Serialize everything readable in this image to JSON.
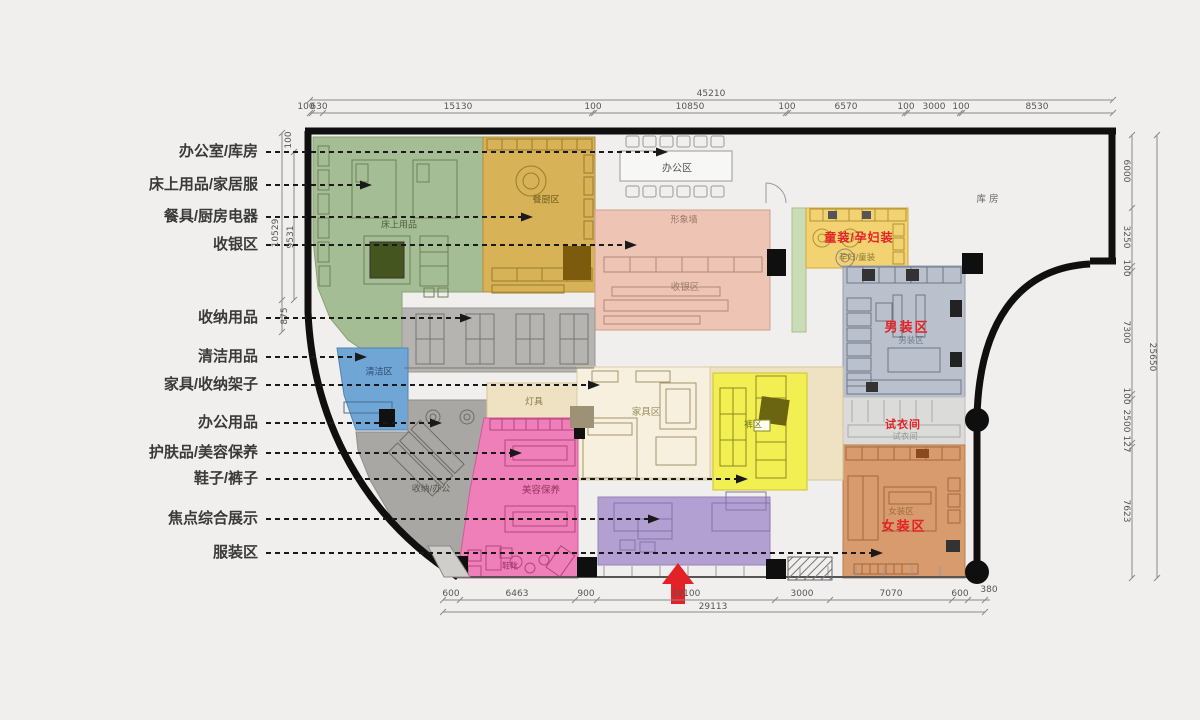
{
  "legend": {
    "items": [
      {
        "label": "办公室/库房"
      },
      {
        "label": "床上用品/家居服"
      },
      {
        "label": "餐具/厨房电器"
      },
      {
        "label": "收银区"
      },
      {
        "label": "收纳用品"
      },
      {
        "label": "清洁用品"
      },
      {
        "label": "家具/收纳架子"
      },
      {
        "label": "办公用品"
      },
      {
        "label": "护肤品/美容保养"
      },
      {
        "label": "鞋子/裤子"
      },
      {
        "label": "焦点综合展示"
      },
      {
        "label": "服装区"
      }
    ]
  },
  "zones": {
    "bedding": {
      "label": "床上用品"
    },
    "kitchen": {
      "label": "餐厨区"
    },
    "office": {
      "label": "办公区"
    },
    "image_wall": {
      "label": "形象墙"
    },
    "cashier": {
      "label": "收银区"
    },
    "kids": {
      "label": "童装/孕妇装",
      "sub": "孕妇/童装"
    },
    "storage_room": {
      "label": "库房"
    },
    "mens": {
      "label": "男装区",
      "sub": "男装区"
    },
    "fitting": {
      "label": "试衣间",
      "sub": "试衣间"
    },
    "womens": {
      "label": "女装区",
      "sub": "女装区"
    },
    "cleaning": {
      "label": "清洁区"
    },
    "storage_office": {
      "label": "收纳/办公"
    },
    "beauty": {
      "label": "美容保养",
      "sub": "鞋靴"
    },
    "lighting": {
      "label": "灯具"
    },
    "furniture": {
      "label": "家具区"
    },
    "pants": {
      "label": "裤区"
    }
  },
  "dims": {
    "top": {
      "total": "45210",
      "segments": [
        "100",
        "630",
        "15130",
        "100",
        "10850",
        "100",
        "6570",
        "100",
        "3000",
        "100",
        "8530"
      ]
    },
    "bottom": {
      "total": "29113",
      "segments": [
        "600",
        "6463",
        "900",
        "10100",
        "3000",
        "7070",
        "600",
        "380"
      ]
    },
    "right": {
      "total": "25650",
      "segments": [
        "6000",
        "3250",
        "100",
        "7300",
        "100",
        "2500",
        "127",
        "7623"
      ]
    },
    "left": {
      "values": [
        "100",
        "10529",
        "9531",
        "875"
      ]
    }
  },
  "colors": {
    "background": "#f0efed",
    "wall": "#0f0f0f",
    "accent_red": "#e32227",
    "bedding": "#a4bd94",
    "kitchen": "#d7b257",
    "cashier": "#eec4b5",
    "kids": "#f2d271",
    "kids_strip": "#cadcb6",
    "mens": "#bac1cc",
    "fitting": "#dbdbd9",
    "womens": "#d89b6e",
    "shelving": "#b5b4b1",
    "cleaning": "#6fa6d6",
    "storage_office": "#a9a7a3",
    "beauty": "#ef7fb9",
    "lighting": "#efe2c2",
    "furniture": "#f7f0de",
    "pants": "#f2ef52",
    "focus_display": "#b3a0d2"
  }
}
